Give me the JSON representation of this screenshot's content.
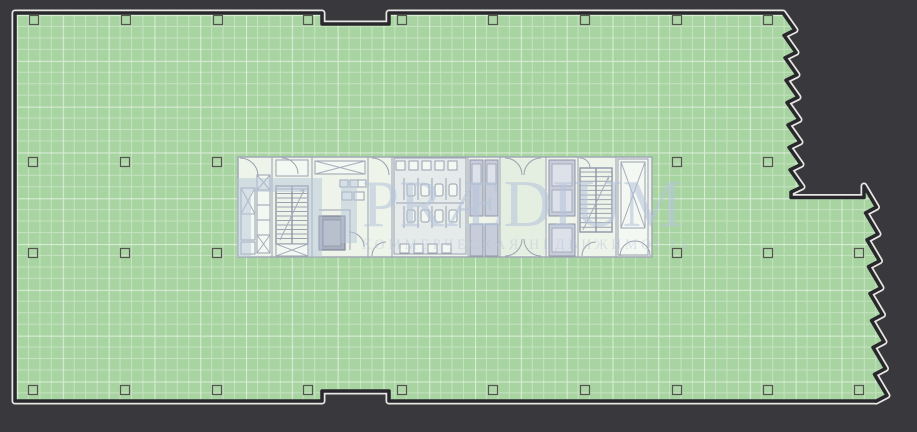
{
  "watermark": {
    "brand": "PRÆDIUM",
    "tagline": "КОММЕРЧЕСКАЯ НЕДВИЖИМОСТЬ"
  },
  "colors": {
    "background": "#39383d",
    "floor_fill": "#a8d4a2",
    "outline": "#28272c",
    "outline_halo": "#e8e6e2",
    "core_background": "#eef4ea",
    "lobby_fill": "#e4efe2",
    "wc_tint": "#d9e0ea",
    "shaft_fill": "#c7cdda",
    "wall_line": "#9aa1b0",
    "column_stroke": "#55544f",
    "watermark_color": "#b6c5da"
  },
  "plan": {
    "type": "office-floor-plan",
    "column_grid": {
      "size": 9,
      "rows": [
        {
          "y": 20,
          "xs": [
            34,
            126,
            218,
            308,
            402,
            493,
            585,
            677,
            768
          ]
        },
        {
          "y": 162,
          "xs": [
            33,
            125,
            217,
            677,
            768
          ]
        },
        {
          "y": 253,
          "xs": [
            33,
            125,
            217,
            677,
            768,
            859
          ]
        },
        {
          "y": 390,
          "xs": [
            33,
            125,
            217,
            308,
            402,
            493,
            585,
            677,
            768,
            859
          ]
        }
      ]
    }
  }
}
